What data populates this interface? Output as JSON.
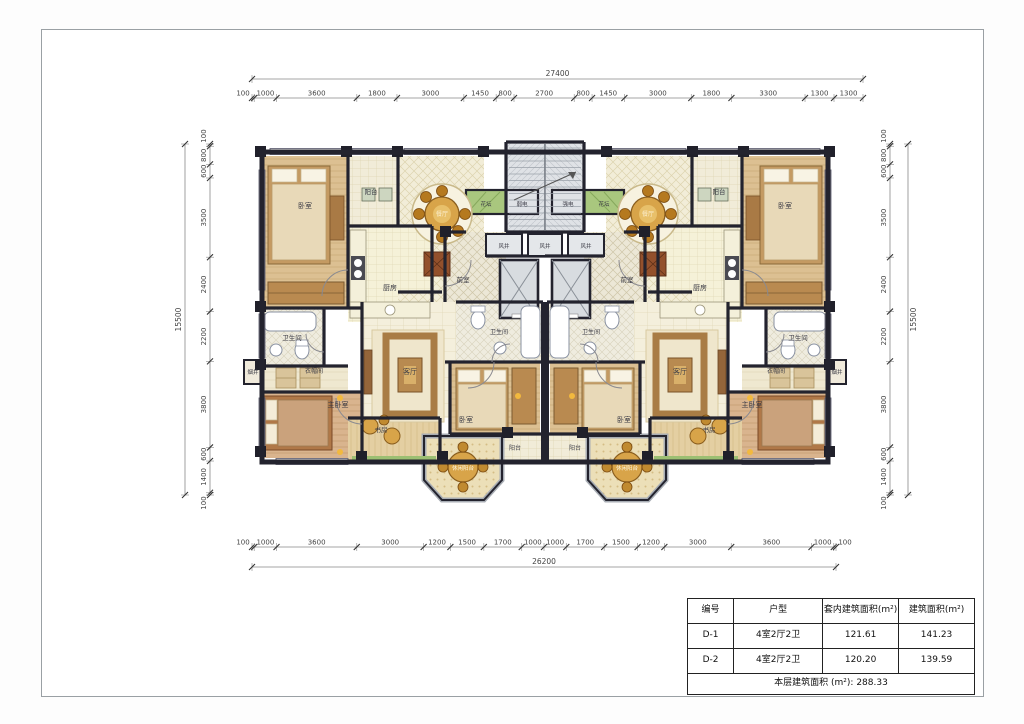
{
  "dimensions": {
    "top": {
      "total": "27400",
      "segments": [
        "100",
        "1000",
        "3600",
        "1800",
        "3000",
        "1450",
        "800",
        "2700",
        "800",
        "1450",
        "3000",
        "1800",
        "3300",
        "1300",
        "1300"
      ]
    },
    "bottom": {
      "total": "26200",
      "segments": [
        "100",
        "1000",
        "3600",
        "3000",
        "1200",
        "1500",
        "1700",
        "1000",
        "1000",
        "1700",
        "1500",
        "1200",
        "3000",
        "3600",
        "1000",
        "100"
      ]
    },
    "left": {
      "total": "15500",
      "segments": [
        "100",
        "800",
        "600",
        "3500",
        "2400",
        "2200",
        "3800",
        "600",
        "1400",
        "100"
      ]
    },
    "right": {
      "total": "15500",
      "segments": [
        "100",
        "800",
        "600",
        "3500",
        "2400",
        "2200",
        "3800",
        "600",
        "1400",
        "100"
      ]
    }
  },
  "plan_labels": {
    "bedroom": "卧室",
    "master_bedroom": "主卧室",
    "balcony": "阳台",
    "leisure_balcony": "休闲阳台",
    "kitchen": "厨房",
    "dining": "餐厅",
    "living": "客厅",
    "study": "书房",
    "bathroom": "卫生间",
    "flower_bed": "花坛",
    "weak_electric": "弱电",
    "strong_electric": "强电",
    "air_shaft": "风井",
    "lobby": "前室",
    "smoke_shaft": "烟井",
    "closet": "衣帽间"
  },
  "area_table": {
    "headers": [
      "编号",
      "户型",
      "套内建筑面积(m²)",
      "建筑面积(m²)"
    ],
    "rows": [
      {
        "id": "D-1",
        "type": "4室2厅2卫",
        "inner_area": "121.61",
        "gross_area": "141.23"
      },
      {
        "id": "D-2",
        "type": "4室2厅2卫",
        "inner_area": "120.20",
        "gross_area": "139.59"
      }
    ],
    "footer": "本层建筑面积 (m²): 288.33"
  },
  "colors": {
    "wall": "#23232e",
    "wood_floor": "#dcc092",
    "tile_floor": "#f2edd8",
    "kitchen_floor": "#f5f1d8",
    "core_gray": "#dfe2e6",
    "flower_green": "#a9c77e",
    "furniture_gold": "#d8a449"
  }
}
